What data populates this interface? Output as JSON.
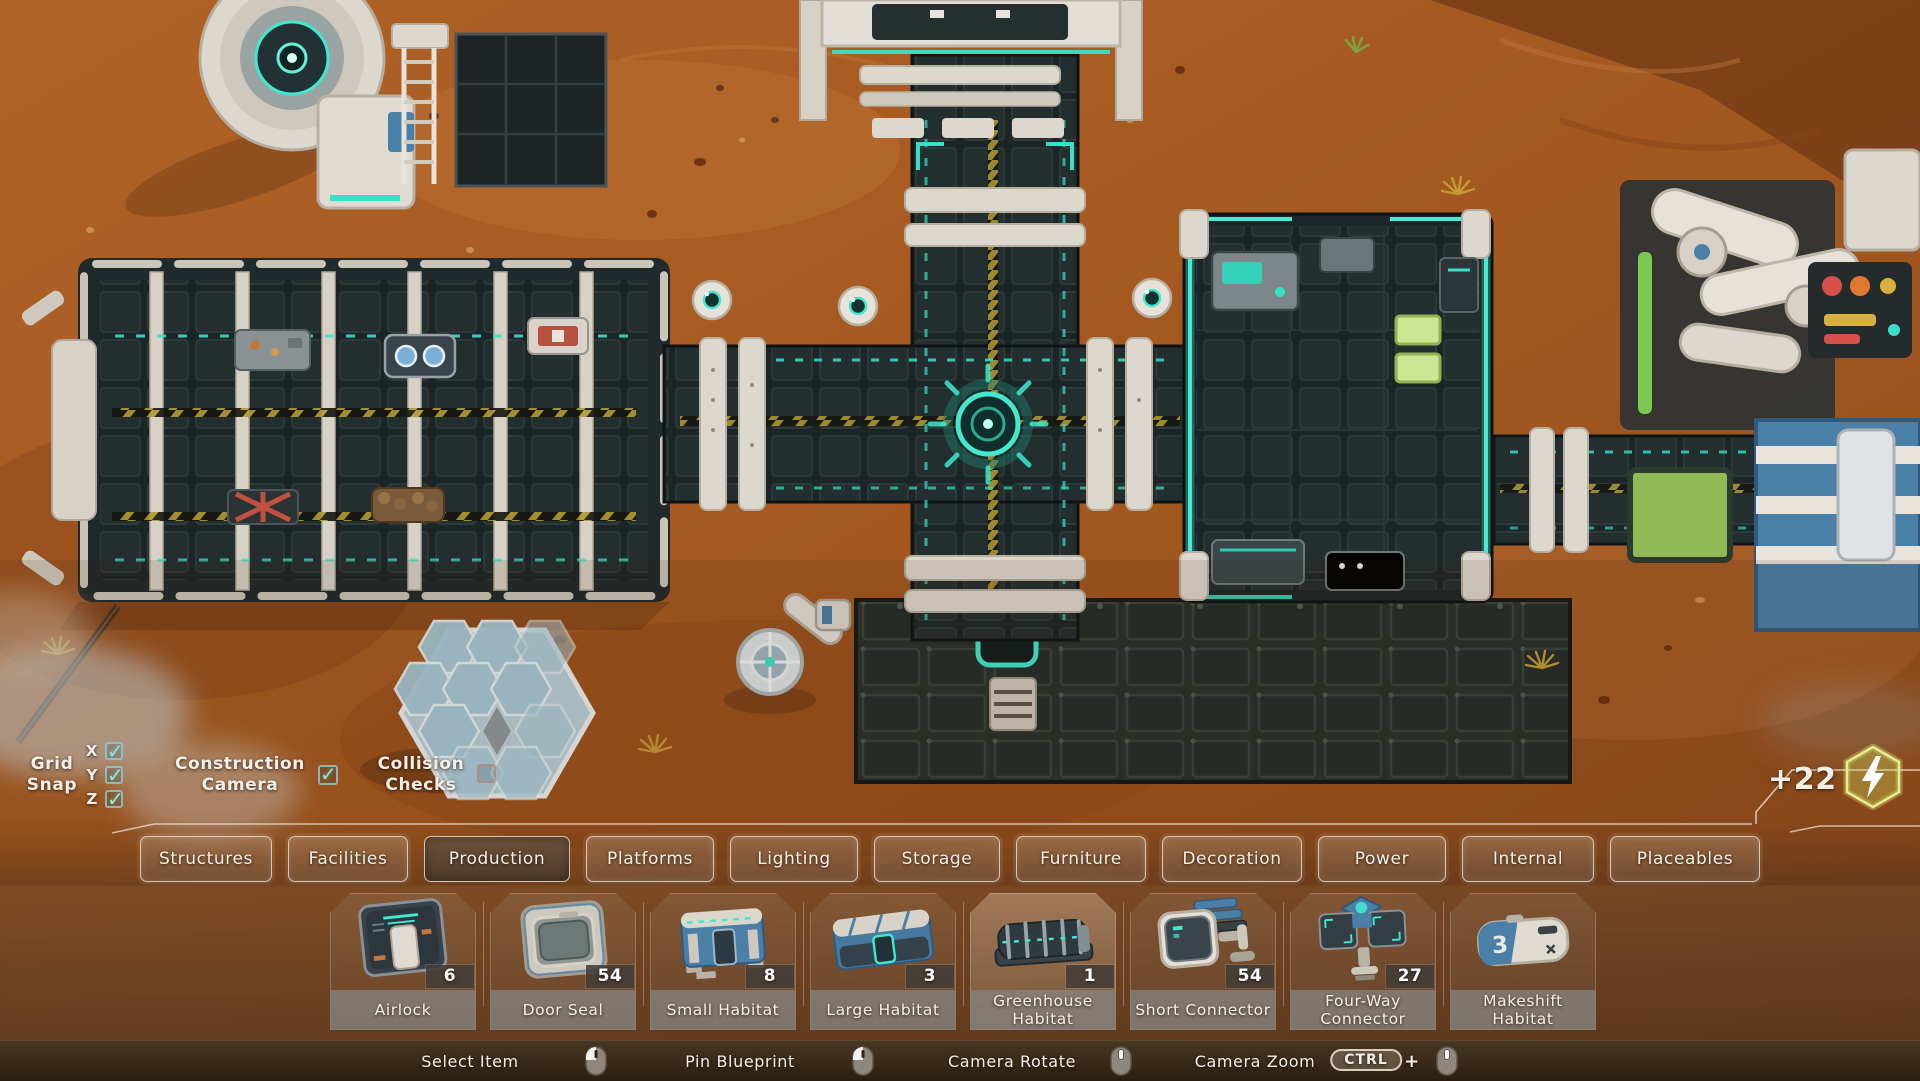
{
  "icons": {
    "checkbox_check": "✓"
  },
  "options": {
    "grid_snap": {
      "line1": "Grid",
      "line2": "Snap",
      "axes": [
        {
          "label": "X",
          "checked": true
        },
        {
          "label": "Y",
          "checked": true
        },
        {
          "label": "Z",
          "checked": true
        }
      ]
    },
    "construction_camera": {
      "line1": "Construction",
      "line2": "Camera",
      "checked": true
    },
    "collision_checks": {
      "line1": "Collision",
      "line2": "Checks",
      "checked": false
    }
  },
  "power": {
    "value": "+22"
  },
  "tabs": [
    {
      "label": "Structures",
      "selected": false
    },
    {
      "label": "Facilities",
      "selected": false
    },
    {
      "label": "Production",
      "selected": true
    },
    {
      "label": "Platforms",
      "selected": false
    },
    {
      "label": "Lighting",
      "selected": false
    },
    {
      "label": "Storage",
      "selected": false
    },
    {
      "label": "Furniture",
      "selected": false
    },
    {
      "label": "Decoration",
      "selected": false
    },
    {
      "label": "Power",
      "selected": false
    },
    {
      "label": "Internal",
      "selected": false
    },
    {
      "label": "Placeables",
      "selected": false
    }
  ],
  "items": [
    {
      "name": "Airlock",
      "count": "6",
      "highlighted": false
    },
    {
      "name": "Door Seal",
      "count": "54",
      "highlighted": false
    },
    {
      "name": "Small Habitat",
      "count": "8",
      "highlighted": false
    },
    {
      "name": "Large Habitat",
      "count": "3",
      "highlighted": false
    },
    {
      "name": "Greenhouse Habitat",
      "count": "1",
      "highlighted": true
    },
    {
      "name": "Short Connector",
      "count": "54",
      "highlighted": false
    },
    {
      "name": "Four-Way Connector",
      "count": "27",
      "highlighted": false
    },
    {
      "name": "Makeshift Habitat",
      "count": null,
      "highlighted": false,
      "art_number": "3"
    }
  ],
  "hints": [
    {
      "label": "Select Item",
      "device": "mouse-left"
    },
    {
      "label": "Pin Blueprint",
      "device": "mouse-left"
    },
    {
      "label": "Camera Rotate",
      "device": "mouse-middle"
    },
    {
      "label": "Camera Zoom",
      "key": "CTRL",
      "plus": "+",
      "device": "mouse-middle"
    }
  ]
}
